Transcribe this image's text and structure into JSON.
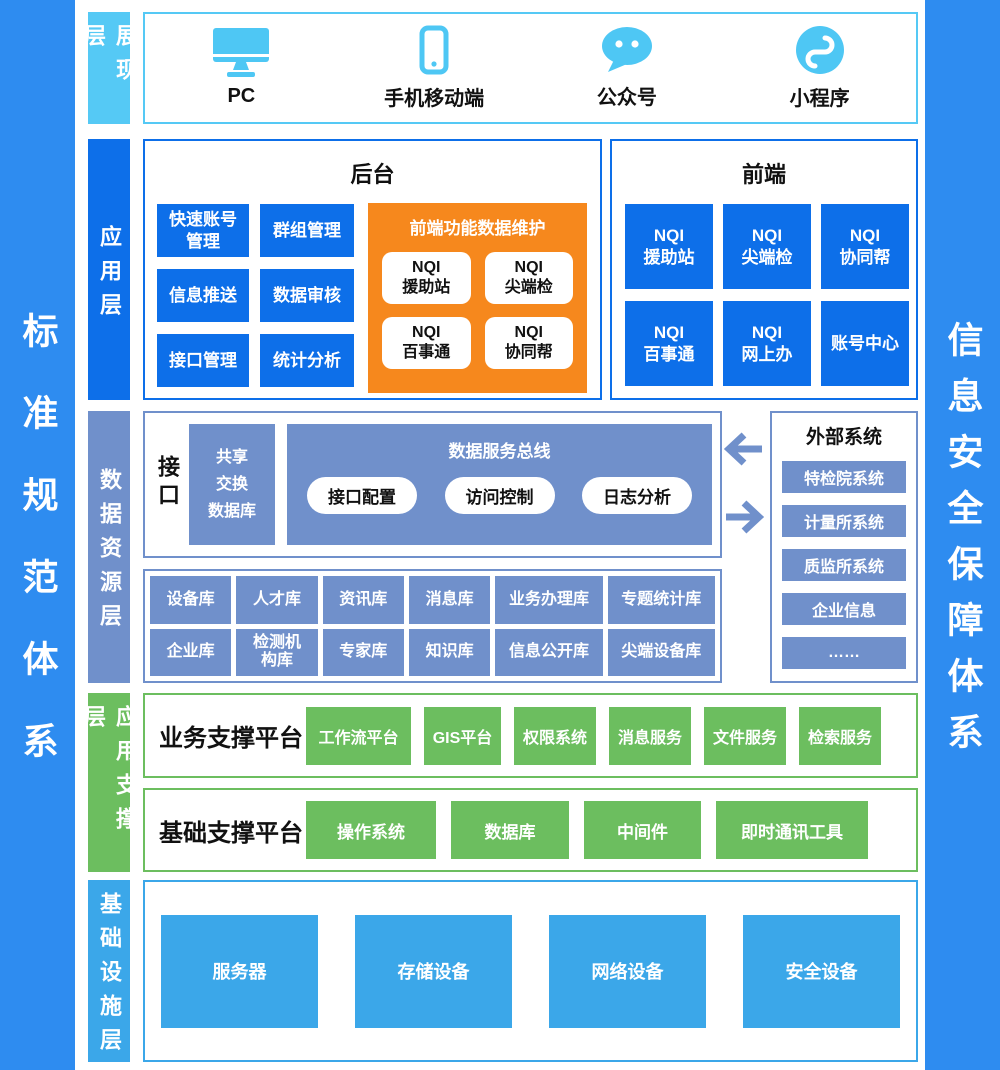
{
  "sidebars": {
    "left": "标准规范体系",
    "right": "信息安全保障体系"
  },
  "layer_labels": {
    "presentation": "展现层",
    "application": "应用层",
    "data": "数据资源层",
    "support": "应用支撑层",
    "infrastructure": "基础设施层"
  },
  "presentation": {
    "devices": [
      {
        "label": "PC",
        "icon": "monitor-icon"
      },
      {
        "label": "手机移动端",
        "icon": "phone-icon"
      },
      {
        "label": "公众号",
        "icon": "chat-bubble-icon"
      },
      {
        "label": "小程序",
        "icon": "miniprogram-icon"
      }
    ]
  },
  "application": {
    "backend": {
      "title": "后台",
      "modules": [
        "快速账号\n管理",
        "群组管理",
        "信息推送",
        "数据审核",
        "接口管理",
        "统计分析"
      ],
      "maintenance": {
        "title": "前端功能数据维护",
        "items": [
          "NQI\n援助站",
          "NQI\n尖端检",
          "NQI\n百事通",
          "NQI\n协同帮"
        ]
      }
    },
    "frontend": {
      "title": "前端",
      "modules": [
        "NQI\n援助站",
        "NQI\n尖端检",
        "NQI\n协同帮",
        "NQI\n百事通",
        "NQI\n网上办",
        "账号中心"
      ]
    }
  },
  "data_layer": {
    "interface_label": "数据接口",
    "share_db": "共享\n交换\n数据库",
    "service_bus": {
      "title": "数据服务总线",
      "pills": [
        "接口配置",
        "访问控制",
        "日志分析"
      ]
    },
    "external": {
      "title": "外部系统",
      "items": [
        "特检院系统",
        "计量所系统",
        "质监所系统",
        "企业信息",
        "……"
      ]
    },
    "databases_row1": [
      "设备库",
      "人才库",
      "资讯库",
      "消息库",
      "业务办理库",
      "专题统计库"
    ],
    "databases_row2": [
      "企业库",
      "检测机\n构库",
      "专家库",
      "知识库",
      "信息公开库",
      "尖端设备库"
    ]
  },
  "support_layer": {
    "business": {
      "title": "业务支撑平台",
      "items": [
        "工作流平台",
        "GIS平台",
        "权限系统",
        "消息服务",
        "文件服务",
        "检索服务"
      ]
    },
    "basic": {
      "title": "基础支撑平台",
      "items": [
        "操作系统",
        "数据库",
        "中间件",
        "即时通讯工具"
      ]
    }
  },
  "infrastructure": {
    "items": [
      "服务器",
      "存储设备",
      "网络设备",
      "安全设备"
    ]
  },
  "colors": {
    "sidebar_blue": "#2E8CF0",
    "light_blue": "#55C9F5",
    "icon_blue": "#4EC7F4",
    "bright_blue": "#0D6FE9",
    "orange": "#F6881D",
    "muted_blue": "#7090CB",
    "green": "#6CBE5F",
    "medium_blue": "#3BA7E9"
  }
}
